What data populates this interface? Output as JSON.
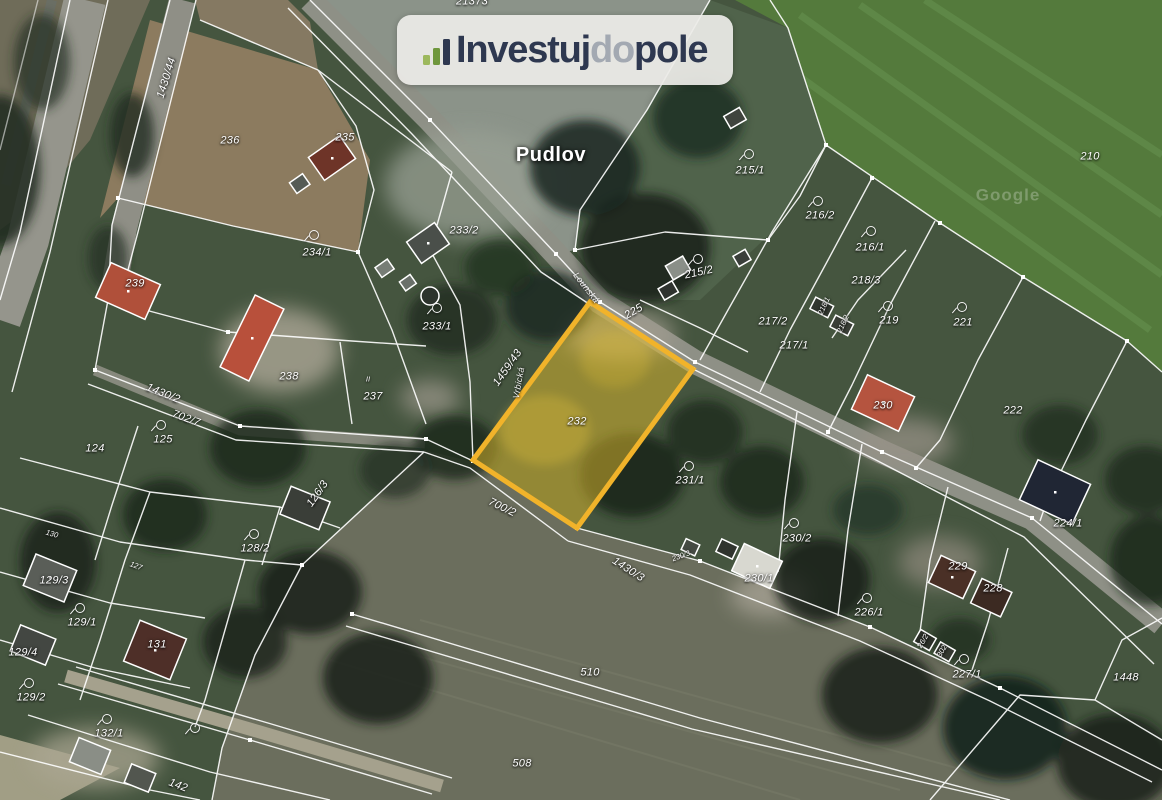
{
  "branding": {
    "logo": {
      "part1": "Investuj",
      "part2": "do",
      "part3": "pole",
      "icon": "growth-bars-icon",
      "background_color": "#edece8",
      "dark_text_color": "#2e3850",
      "light_text_color": "#a3a9b2",
      "bar_colors": [
        "#9cb85c",
        "#6f973d",
        "#2e3850"
      ]
    }
  },
  "map": {
    "type": "satellite-cadastral",
    "highlight": {
      "parcel_number": "232",
      "border_color": "#f1b32a",
      "fill_color": "rgba(226,187,43,0.5)"
    },
    "boundary_line_color": "#ffffff",
    "labels": [
      {
        "text": "21373",
        "x": 472,
        "y": 2
      },
      {
        "text": "Pudlov",
        "x": 551,
        "y": 155,
        "kind": "place"
      },
      {
        "text": "Google",
        "x": 1008,
        "y": 195,
        "kind": "watermark"
      },
      {
        "text": "1430/44",
        "x": 167,
        "y": 78,
        "rot": -73
      },
      {
        "text": "236",
        "x": 230,
        "y": 141
      },
      {
        "text": "235",
        "x": 345,
        "y": 138
      },
      {
        "text": "234/1",
        "x": 317,
        "y": 253
      },
      {
        "text": "233/2",
        "x": 464,
        "y": 231
      },
      {
        "text": "233/1",
        "x": 437,
        "y": 327
      },
      {
        "text": "239",
        "x": 135,
        "y": 284
      },
      {
        "text": "238",
        "x": 289,
        "y": 377
      },
      {
        "text": "237",
        "x": 373,
        "y": 397
      },
      {
        "text": "II",
        "x": 368,
        "y": 379,
        "kind": "tiny"
      },
      {
        "text": "225",
        "x": 634,
        "y": 312,
        "rot": -30
      },
      {
        "text": "Lounská",
        "x": 586,
        "y": 288,
        "rot": 52,
        "kind": "street"
      },
      {
        "text": "215/1",
        "x": 750,
        "y": 171
      },
      {
        "text": "215/2",
        "x": 699,
        "y": 273,
        "rot": -12
      },
      {
        "text": "216/2",
        "x": 820,
        "y": 216
      },
      {
        "text": "216/1",
        "x": 870,
        "y": 248
      },
      {
        "text": "218/3",
        "x": 866,
        "y": 281
      },
      {
        "text": "218/1",
        "x": 824,
        "y": 306,
        "rot": -65,
        "kind": "tiny"
      },
      {
        "text": "218/2",
        "x": 843,
        "y": 324,
        "rot": -65,
        "kind": "tiny"
      },
      {
        "text": "217/2",
        "x": 773,
        "y": 322
      },
      {
        "text": "217/1",
        "x": 794,
        "y": 346
      },
      {
        "text": "219",
        "x": 889,
        "y": 321
      },
      {
        "text": "221",
        "x": 963,
        "y": 323
      },
      {
        "text": "210",
        "x": 1090,
        "y": 157
      },
      {
        "text": "222",
        "x": 1013,
        "y": 411
      },
      {
        "text": "230",
        "x": 883,
        "y": 406
      },
      {
        "text": "232",
        "x": 577,
        "y": 422,
        "name": "highlighted-parcel-label"
      },
      {
        "text": "1459/43",
        "x": 508,
        "y": 368,
        "rot": -55
      },
      {
        "text": "Vrbická",
        "x": 519,
        "y": 383,
        "rot": -80,
        "kind": "street"
      },
      {
        "text": "231/1",
        "x": 690,
        "y": 481
      },
      {
        "text": "230/2",
        "x": 797,
        "y": 539
      },
      {
        "text": "230/1",
        "x": 759,
        "y": 579
      },
      {
        "text": "230/3",
        "x": 681,
        "y": 556,
        "rot": -20,
        "kind": "tiny"
      },
      {
        "text": "226/1",
        "x": 869,
        "y": 613
      },
      {
        "text": "229",
        "x": 958,
        "y": 567
      },
      {
        "text": "228",
        "x": 993,
        "y": 589
      },
      {
        "text": "224/1",
        "x": 1068,
        "y": 524
      },
      {
        "text": "227/1",
        "x": 967,
        "y": 675
      },
      {
        "text": "1448",
        "x": 1126,
        "y": 678
      },
      {
        "text": "26/2",
        "x": 923,
        "y": 641,
        "rot": -60,
        "kind": "tiny"
      },
      {
        "text": "302",
        "x": 942,
        "y": 651,
        "rot": -60,
        "kind": "tiny"
      },
      {
        "text": "1430/2",
        "x": 163,
        "y": 394,
        "rot": 22
      },
      {
        "text": "702/7",
        "x": 186,
        "y": 419,
        "rot": 20
      },
      {
        "text": "125",
        "x": 163,
        "y": 440
      },
      {
        "text": "124",
        "x": 95,
        "y": 449
      },
      {
        "text": "126/3",
        "x": 318,
        "y": 494,
        "rot": -55
      },
      {
        "text": "128/2",
        "x": 255,
        "y": 549
      },
      {
        "text": "130",
        "x": 52,
        "y": 534,
        "rot": 15,
        "kind": "tiny"
      },
      {
        "text": "127",
        "x": 136,
        "y": 566,
        "rot": 20,
        "kind": "tiny"
      },
      {
        "text": "129/3",
        "x": 54,
        "y": 581
      },
      {
        "text": "129/1",
        "x": 82,
        "y": 623
      },
      {
        "text": "129/4",
        "x": 23,
        "y": 653
      },
      {
        "text": "129/2",
        "x": 31,
        "y": 698
      },
      {
        "text": "131",
        "x": 157,
        "y": 645
      },
      {
        "text": "132/1",
        "x": 109,
        "y": 734
      },
      {
        "text": "142",
        "x": 178,
        "y": 786,
        "rot": 20
      },
      {
        "text": "510",
        "x": 590,
        "y": 673
      },
      {
        "text": "508",
        "x": 522,
        "y": 764
      },
      {
        "text": "1430/3",
        "x": 628,
        "y": 570,
        "rot": 33
      },
      {
        "text": "700/2",
        "x": 502,
        "y": 508,
        "rot": 26
      }
    ],
    "garden_symbols": [
      {
        "x": 313,
        "y": 234
      },
      {
        "x": 436,
        "y": 307
      },
      {
        "x": 748,
        "y": 153
      },
      {
        "x": 697,
        "y": 258
      },
      {
        "x": 817,
        "y": 200
      },
      {
        "x": 870,
        "y": 230
      },
      {
        "x": 887,
        "y": 305
      },
      {
        "x": 961,
        "y": 306
      },
      {
        "x": 688,
        "y": 465
      },
      {
        "x": 793,
        "y": 522
      },
      {
        "x": 866,
        "y": 597
      },
      {
        "x": 963,
        "y": 658
      },
      {
        "x": 160,
        "y": 424
      },
      {
        "x": 253,
        "y": 533
      },
      {
        "x": 79,
        "y": 607
      },
      {
        "x": 28,
        "y": 682
      },
      {
        "x": 106,
        "y": 718
      },
      {
        "x": 194,
        "y": 727
      }
    ]
  }
}
